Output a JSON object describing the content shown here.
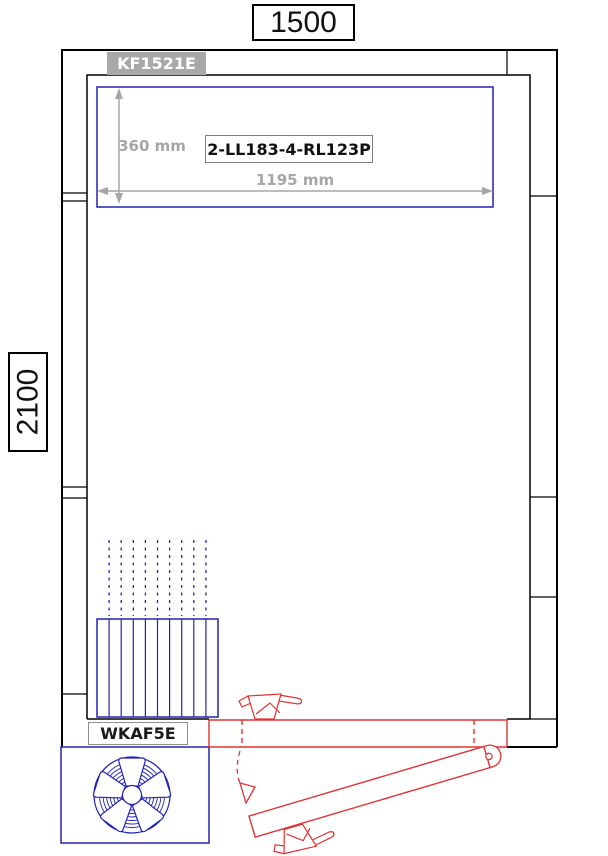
{
  "frame": {
    "width_label": "1500",
    "height_label": "2100"
  },
  "ceiling_unit": {
    "model_label": "KF1521E",
    "part_number": "2-LL183-4-RL123P",
    "depth_dim": "360 mm",
    "width_dim": "1195 mm"
  },
  "fan_unit": {
    "model_label": "WKAF5E"
  },
  "icons": {
    "fan": "fan-icon",
    "door_swing": "door-swing-arrow-icon"
  },
  "colors": {
    "wall_black": "#000000",
    "component_blue": "#2323b4",
    "door_red": "#e03232",
    "dim_gray": "#a6a6a6",
    "model_tag_bg": "#a8a8a8"
  }
}
